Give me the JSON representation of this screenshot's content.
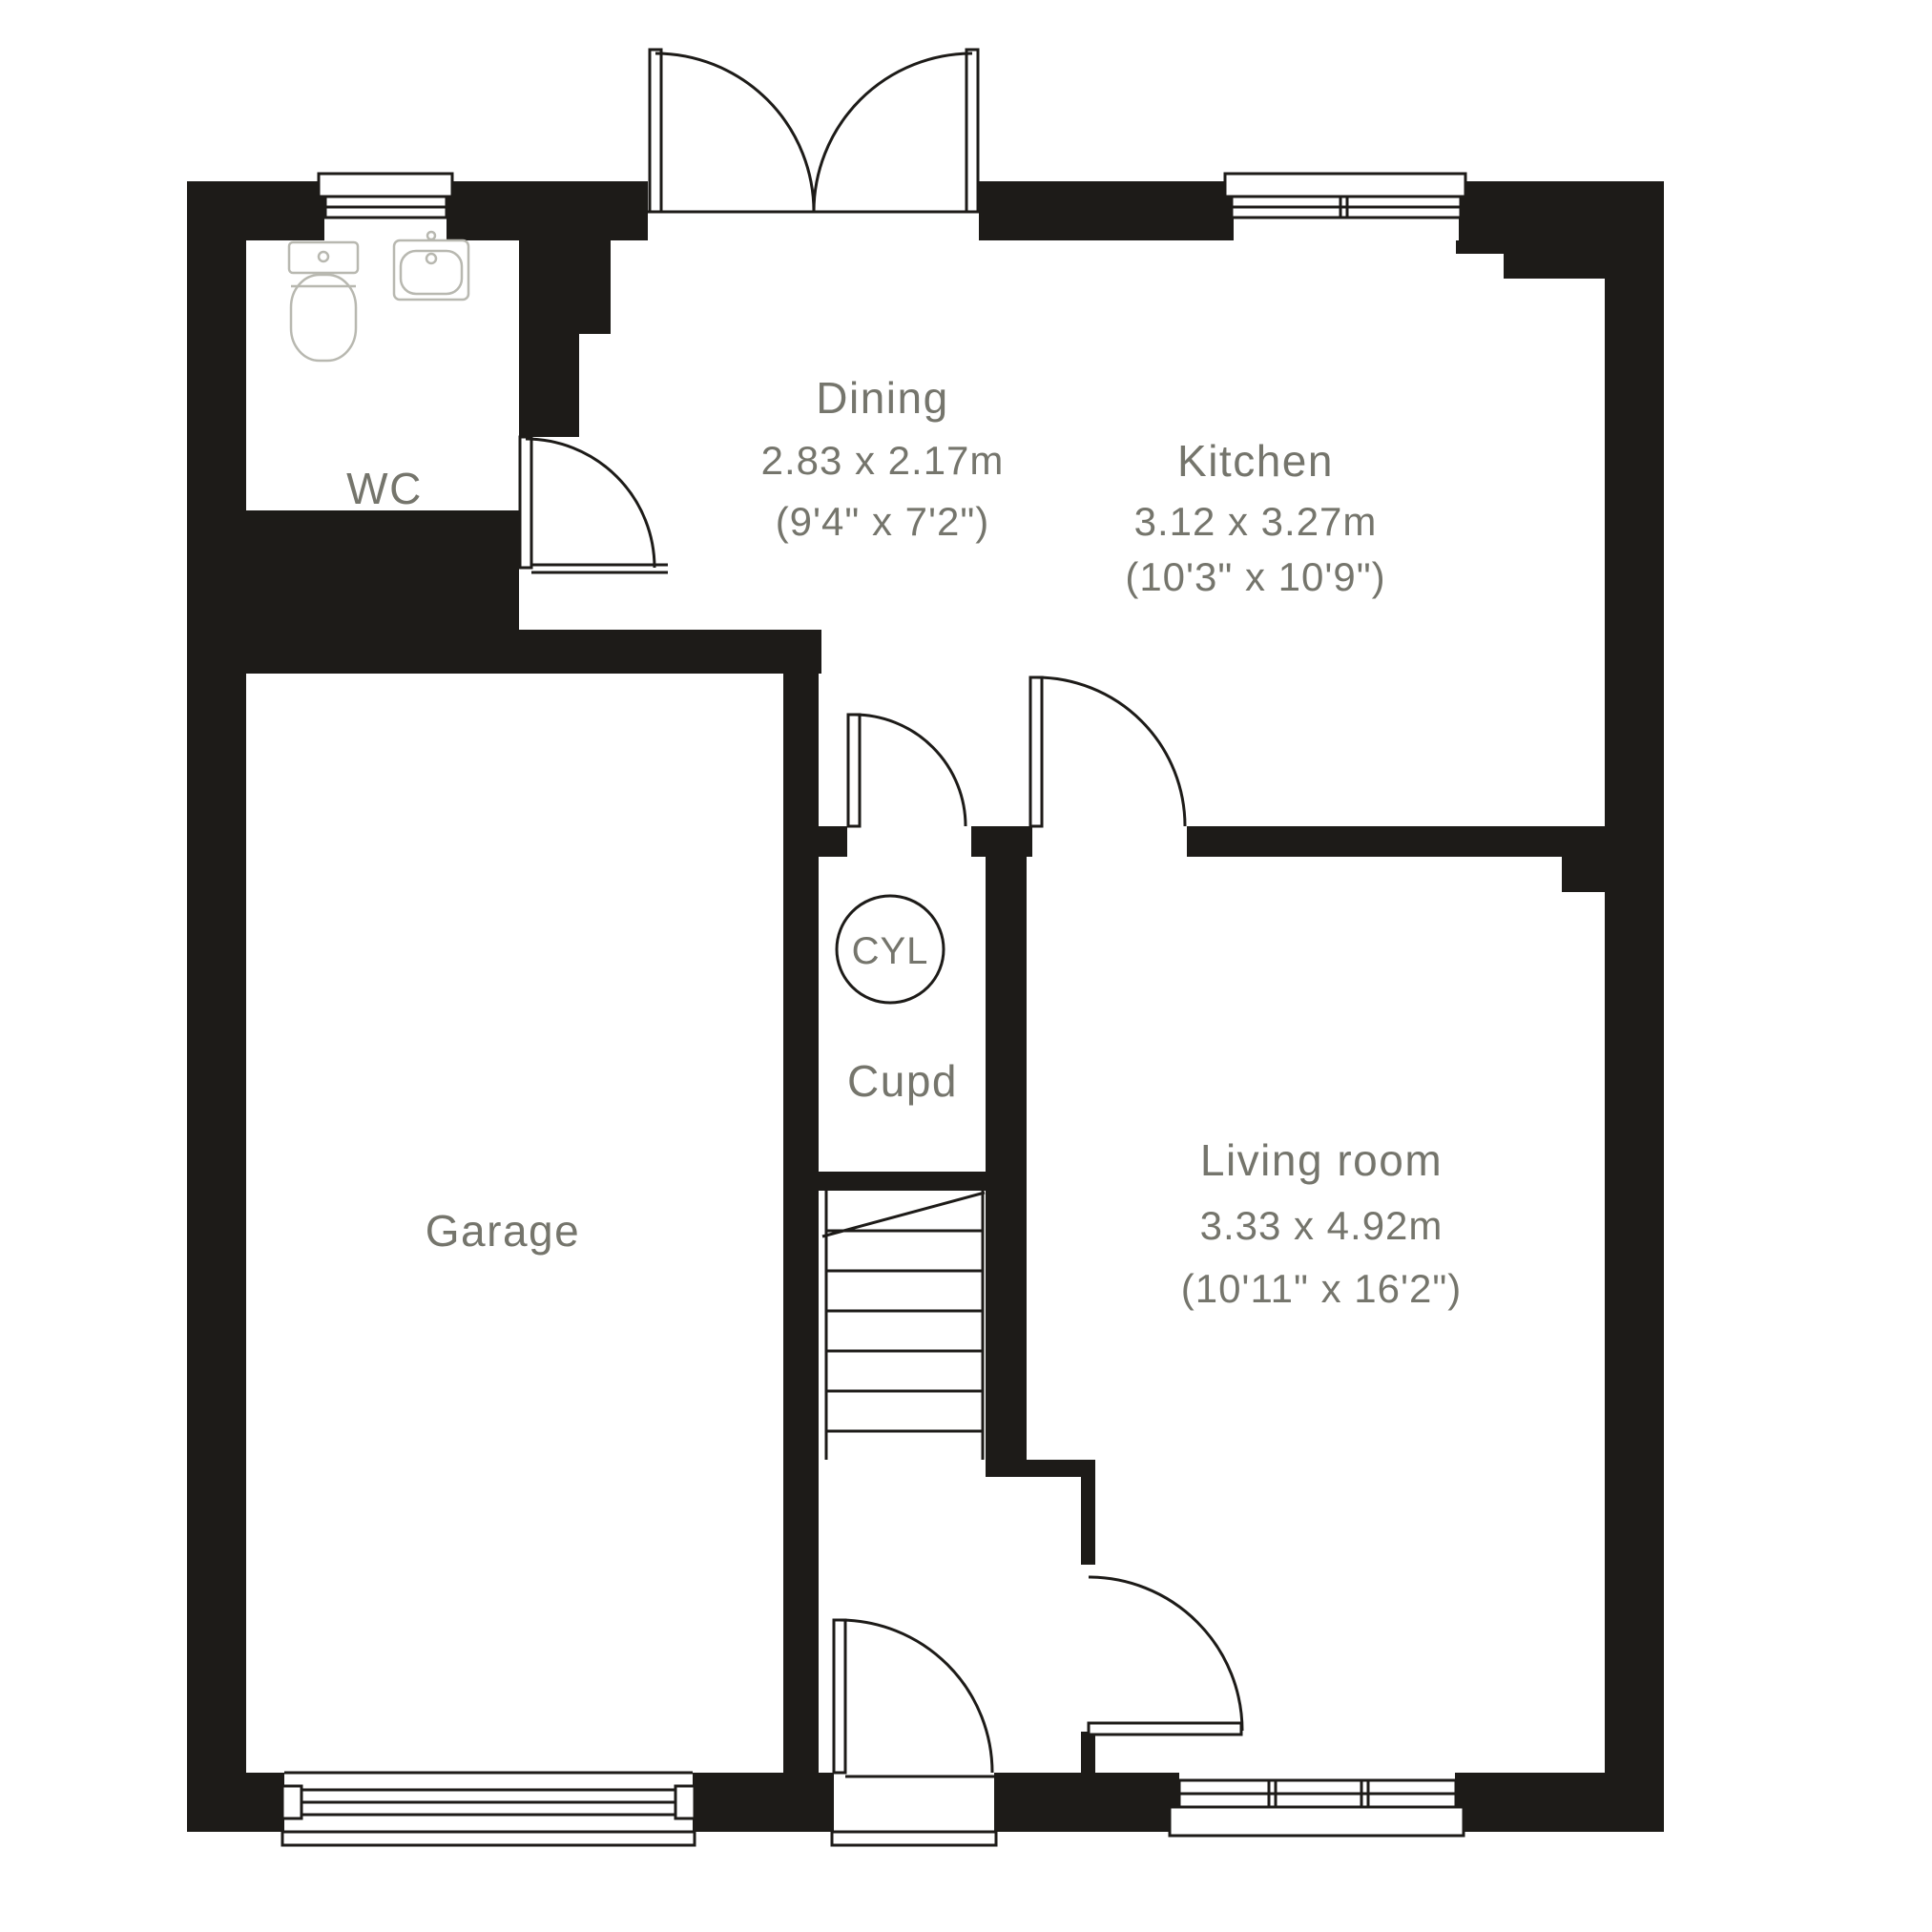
{
  "plan": {
    "type": "floor-plan",
    "rooms": {
      "wc": {
        "name": "WC"
      },
      "dining": {
        "name": "Dining",
        "size_m": "2.83 x 2.17m",
        "size_ft": "(9'4\" x 7'2\")"
      },
      "kitchen": {
        "name": "Kitchen",
        "size_m": "3.12 x 3.27m",
        "size_ft": "(10'3\" x 10'9\")"
      },
      "garage": {
        "name": "Garage"
      },
      "cupboard": {
        "name": "Cupd"
      },
      "cylinder": {
        "label": "CYL"
      },
      "living": {
        "name": "Living room",
        "size_m": "3.33 x 4.92m",
        "size_ft": "(10'11\" x 16'2\")"
      }
    },
    "colors": {
      "wall": "#1d1b18",
      "label_text": "#75756c",
      "fixture_outline": "#b8b8b0",
      "background": "#ffffff"
    }
  }
}
